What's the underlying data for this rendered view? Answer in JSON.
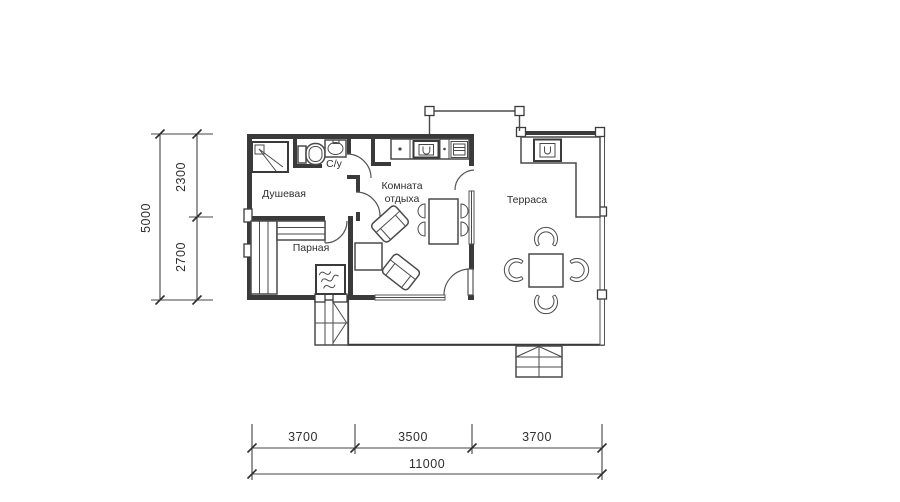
{
  "colors": {
    "wall": "#3a3a3a",
    "furniture": "#4a4a4a",
    "dimension_lines": "#444444",
    "text": "#2f2f2f",
    "background": "#ffffff"
  },
  "rooms": {
    "shower": {
      "label": "Душевая"
    },
    "wc": {
      "label": "С/у"
    },
    "steam": {
      "label": "Парная"
    },
    "lounge": {
      "label_line1": "Комната",
      "label_line2": "отдыха"
    },
    "terrace": {
      "label": "Терраса"
    }
  },
  "dimensions": {
    "left": {
      "segments": [
        "2300",
        "2700"
      ],
      "total": "5000"
    },
    "bottom": {
      "segments": [
        "3700",
        "3500",
        "3700"
      ],
      "total": "11000"
    }
  }
}
